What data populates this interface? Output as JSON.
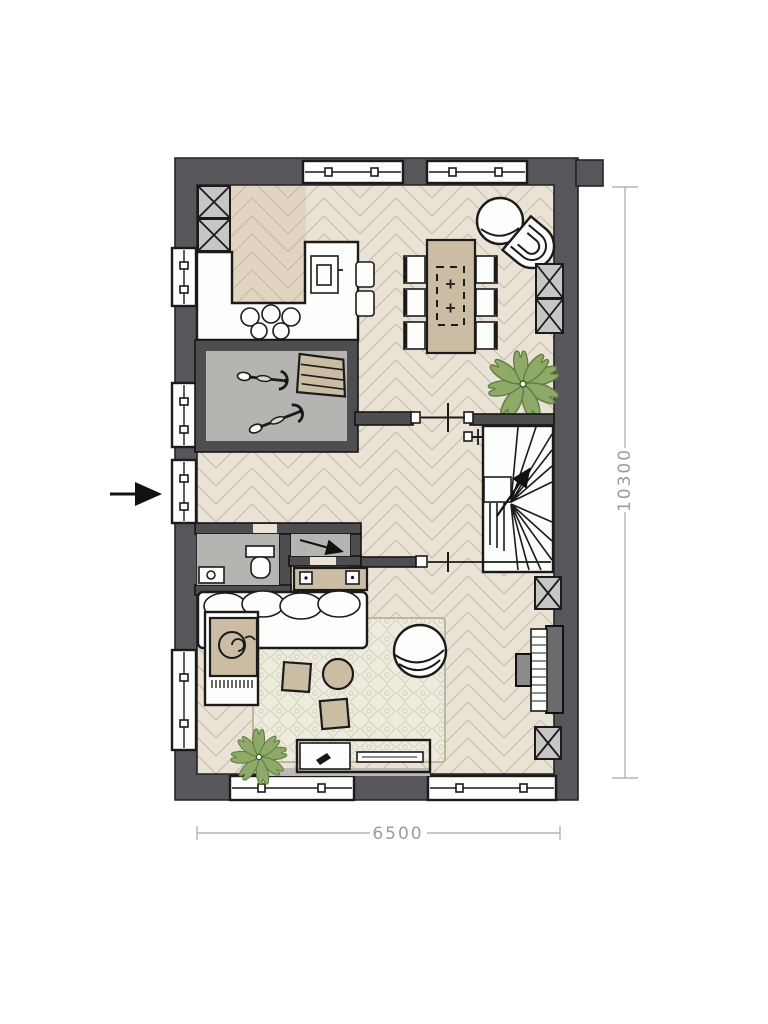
{
  "title": "house-ground-floor-plan",
  "plan": {
    "dimensions": {
      "width": "6500",
      "height": "10300"
    },
    "colors": {
      "wall": "#57575b",
      "interior-wall": "#4e4e50",
      "floor-base": "#eae3d5",
      "floor-line": "#c8bfae",
      "gray-floor": "#b5b4b1",
      "cabinet-gray": "#c6c6c5",
      "beige": "#cbbda4",
      "rug-base": "#eeecdf",
      "rug-line": "#d7d3c0",
      "plant": "#8fa968",
      "plant-dark": "#5f7f45",
      "piano-dark": "#6b6b6d",
      "dim-line": "#a8a8a8",
      "dim-text": "#9b9b9b"
    },
    "symbols": [
      "entrance-arrow",
      "window",
      "tall-cabinet",
      "kitchen-counter",
      "cooktop-burners",
      "kitchen-island",
      "sink",
      "bar-stool",
      "dining-table",
      "pendant-zone",
      "dining-chair",
      "lounge-chair",
      "shell-chair",
      "plant",
      "storage-room",
      "bicycle",
      "stepladder",
      "radiator",
      "winder-staircase",
      "stair-direction-arrow",
      "toilet",
      "washbasin",
      "under-stairs-cupboard",
      "cupboard-arrow",
      "glass-partition",
      "sideboard",
      "sofa",
      "chaise-longue",
      "throw-blanket",
      "rug",
      "coffee-table",
      "armchair",
      "tv-lowboard",
      "remote-icon",
      "piano",
      "piano-bench",
      "dimension-line"
    ]
  }
}
